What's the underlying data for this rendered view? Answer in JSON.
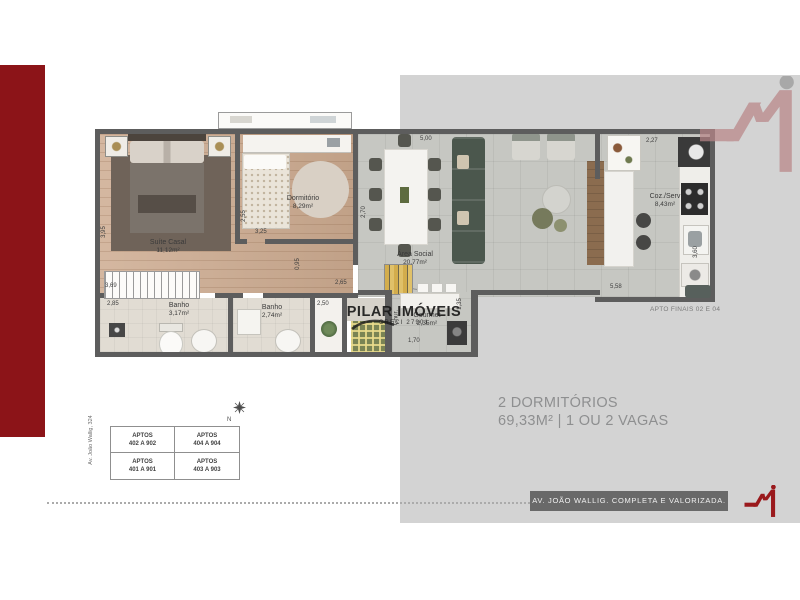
{
  "colors": {
    "accent": "#8c1418",
    "logo_red": "#9a191c",
    "panel": "#d3d3d3",
    "banner_bg": "#696969",
    "wall": "#5d5d5d"
  },
  "summary": {
    "line1": "2 DORMITÓRIOS",
    "line2": "69,33M² | 1 OU 2 VAGAS"
  },
  "banner": {
    "text": "AV. JOÃO WALLIG. COMPLETA E VALORIZADA."
  },
  "plan": {
    "note": "APTO FINAIS 02 E 04",
    "watermark": {
      "name": "PILAR IMÓVEIS",
      "creci": "CRECI 27901"
    },
    "rooms": {
      "suite": {
        "name": "Suíte Casal",
        "area": "11,12m²"
      },
      "dorm": {
        "name": "Dormitório",
        "area": "8,29m²"
      },
      "banho1": {
        "name": "Banho",
        "area": "3,17m²"
      },
      "banho2": {
        "name": "Banho",
        "area": "2,74m²"
      },
      "social": {
        "name": "Área Social",
        "area": "20,77m²"
      },
      "gourmet": {
        "name": "Gourmet",
        "area": "2,35m²"
      },
      "cozserv": {
        "name": "Coz./Serv",
        "area": "8,43m²"
      },
      "chur": {
        "name": "Chur."
      }
    },
    "dims": {
      "suite_depth": "3,95",
      "suite_len": "3,69",
      "dorm_depth": "2,55",
      "dorm_len": "3,25",
      "hall": "0,95",
      "banho1": "2,85",
      "closet": "2,50",
      "living_left": "2,65",
      "living_depth": "2,70",
      "living_len": "5,00",
      "gourmet_depth": "1,35",
      "gourmet_len": "1,70",
      "kitchen_top": "2,27",
      "kitchen_len": "5,58",
      "kitchen_depth": "3,60"
    }
  },
  "units_table": {
    "cells": [
      {
        "label": "APTOS",
        "range": "402 A 902"
      },
      {
        "label": "APTOS",
        "range": "404 A 904"
      },
      {
        "label": "APTOS",
        "range": "401 A 901"
      },
      {
        "label": "APTOS",
        "range": "403 A 903"
      }
    ]
  },
  "street": {
    "label": "Av. João Wallig, 324"
  },
  "compass": {
    "label": "N"
  },
  "icons": {
    "brand": "m-zigzag-mark",
    "compass": "north-arrow"
  }
}
